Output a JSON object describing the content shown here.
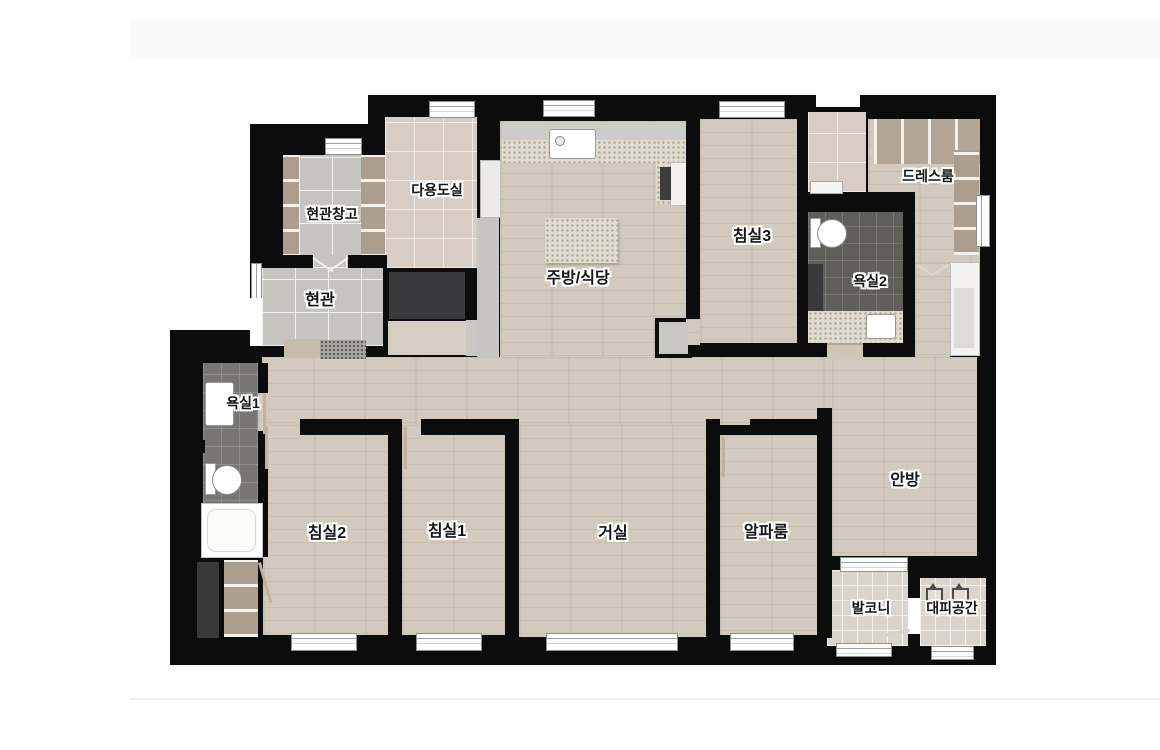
{
  "page": {
    "type": "apartment-floor-plan",
    "background_color": "#ffffff",
    "top_band_color": "#fafafa",
    "divider_color": "#ededed"
  },
  "floorplan": {
    "palette": {
      "wall": "#0c0c0c",
      "wood_floor": "#d2cabf",
      "entrance_tile": "#c6c4c0",
      "utility_tile": "#d8cdc5",
      "bath_tile_light": "#787672",
      "bath_tile_dark": "#5f5e5b",
      "balcony_tile": "#d9d5cd",
      "counter_speckle": "#e0dccf",
      "closet_wood": "#ab9e8e",
      "label_text": "#141414",
      "label_halo": "#ffffff"
    },
    "rooms": [
      {
        "id": "entrance-storage",
        "label": "현관창고"
      },
      {
        "id": "utility-room",
        "label": "다용도실"
      },
      {
        "id": "kitchen-dining",
        "label": "주방/식당"
      },
      {
        "id": "bedroom-3",
        "label": "침실3"
      },
      {
        "id": "dress-room",
        "label": "드레스룸"
      },
      {
        "id": "bathroom-2",
        "label": "욕실2"
      },
      {
        "id": "entrance",
        "label": "현관"
      },
      {
        "id": "bathroom-1",
        "label": "욕실1"
      },
      {
        "id": "bedroom-2",
        "label": "침실2"
      },
      {
        "id": "bedroom-1",
        "label": "침실1"
      },
      {
        "id": "living-room",
        "label": "거실"
      },
      {
        "id": "alpha-room",
        "label": "알파룸"
      },
      {
        "id": "master-bedroom",
        "label": "안방"
      },
      {
        "id": "balcony",
        "label": "발코니"
      },
      {
        "id": "refuge-space",
        "label": "대피공간"
      }
    ],
    "fixtures": [
      "kitchen-sink",
      "cooktop",
      "kitchen-island",
      "toilet",
      "washbasin",
      "bathtub",
      "wardrobe",
      "closet",
      "window",
      "door",
      "escape-hatch"
    ]
  }
}
